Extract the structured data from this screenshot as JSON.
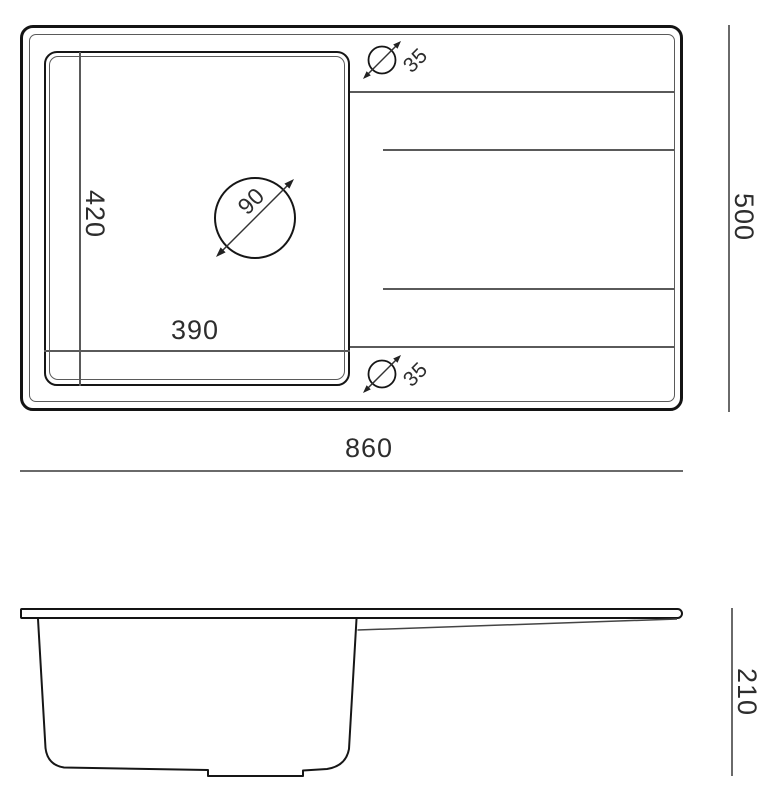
{
  "drawing": {
    "dimensions": {
      "bowl_depth": "420",
      "bowl_width": "390",
      "drain_diameter": "90",
      "tap_hole_top": "35",
      "tap_hole_bottom": "35",
      "overall_width": "860",
      "overall_depth": "500",
      "side_height": "210"
    },
    "colors": {
      "background": "#ffffff",
      "outline": "#141414",
      "thin_line": "#5a5a5a",
      "dimension_line": "#6a6a6a",
      "text": "#2d2d2d"
    }
  }
}
